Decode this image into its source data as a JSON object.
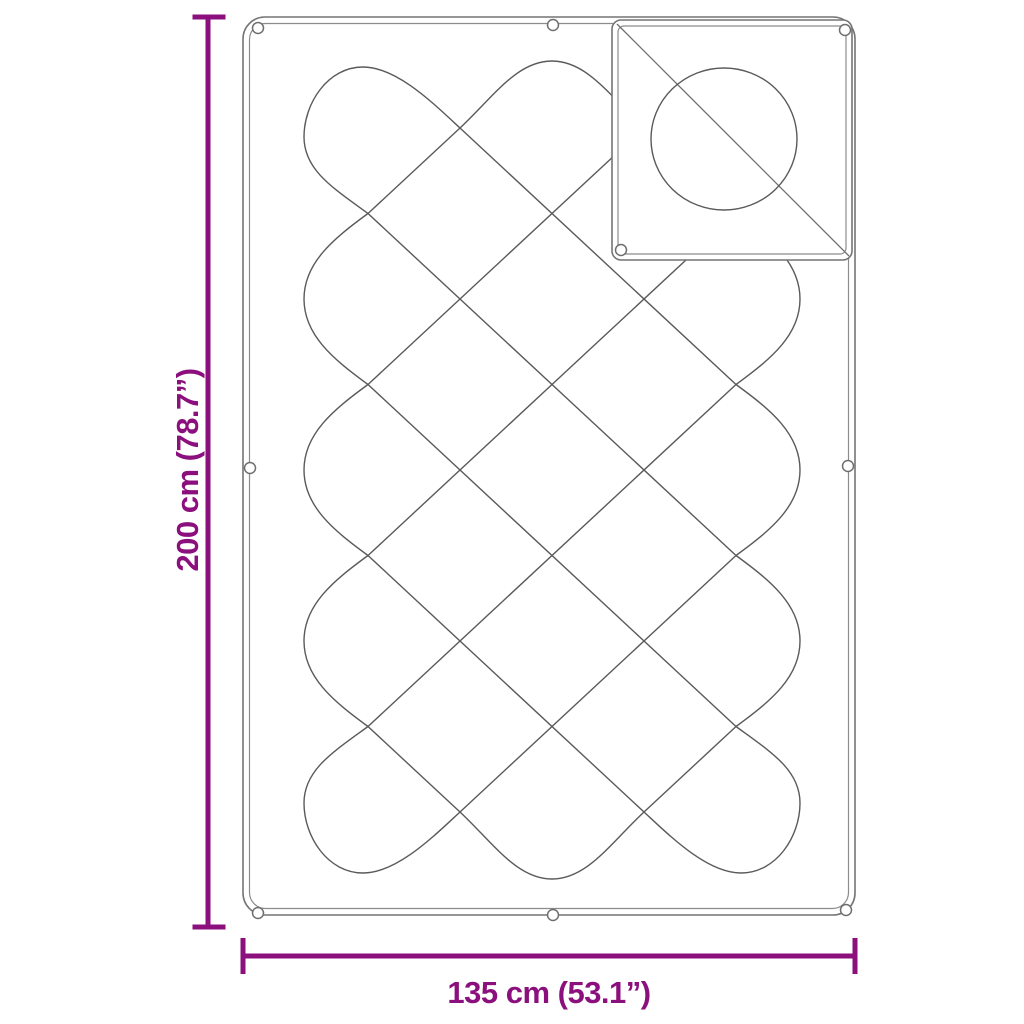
{
  "diagram": {
    "kind": "quilted blanket dimension diagram",
    "dimensions": {
      "height_label": "200 cm (78.7”)",
      "width_label": "135 cm (53.1”)"
    },
    "grommet_count": 9,
    "colors": {
      "accent": "#8b107d",
      "outline": "#747474",
      "outline_inner": "#8c8c8c",
      "stitch": "#5a5a5a",
      "detail": "#6e6e6e",
      "background": "#ffffff"
    }
  }
}
